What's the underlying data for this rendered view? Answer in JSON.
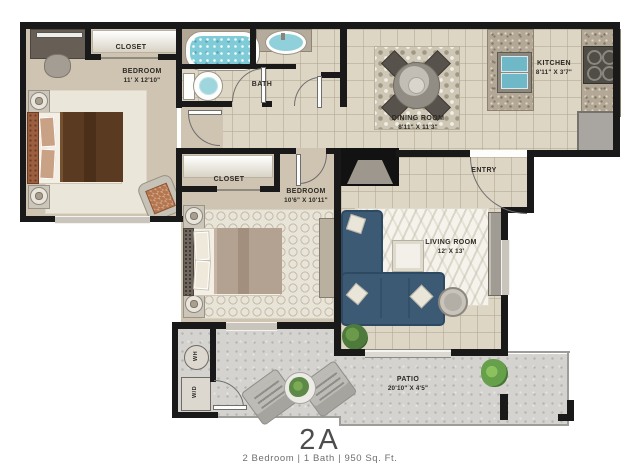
{
  "floorplan": {
    "unit_title": "2A",
    "unit_summary": "2 Bedroom | 1 Bath | 950 Sq. Ft.",
    "rooms": {
      "bedroom1": {
        "name": "BEDROOM",
        "dims": "11' X 12'10\""
      },
      "bedroom2": {
        "name": "BEDROOM",
        "dims": "10'6\" X 10'11\""
      },
      "living_room": {
        "name": "LIVING ROOM",
        "dims": "12' X 13'"
      },
      "dining_room": {
        "name": "DINING ROOM",
        "dims": "8'11\" X 11'3\""
      },
      "kitchen": {
        "name": "KITCHEN",
        "dims": "8'11\" X 3'7\""
      },
      "patio": {
        "name": "PATIO",
        "dims": "20'10\" X 4'5\""
      },
      "bath": {
        "name": "BATH"
      },
      "closet1": {
        "name": "CLOSET"
      },
      "closet2": {
        "name": "CLOSET"
      },
      "entry": {
        "name": "ENTRY"
      },
      "washer_dryer": {
        "name": "W/D"
      },
      "water_heater": {
        "name": "WH"
      }
    },
    "colors": {
      "walls": "#191919",
      "bedroom_floor": "#cfc3b1",
      "tile_floor": "#ded6c5",
      "patio_concrete": "#d4d3cf",
      "sofa_blue": "#3d5a75",
      "bed1_blanket": "#5a3a20",
      "bed2_blanket": "#b5a391",
      "water_blue": "#7fccd8",
      "granite": "#b3a796",
      "plant_green": "#507c3b"
    }
  }
}
